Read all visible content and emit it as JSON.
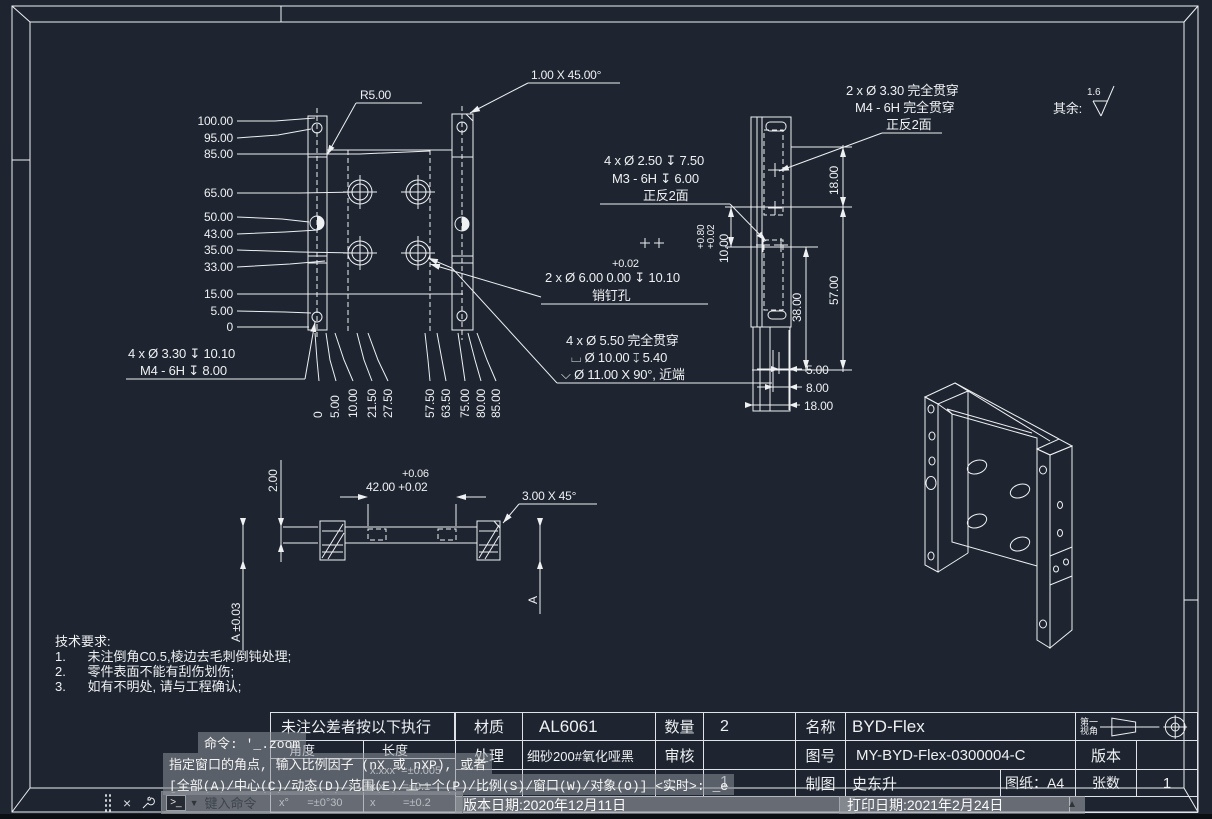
{
  "colors": {
    "background": "#1e2530",
    "line": "#eef0f2",
    "overlay_bg": "#8c9299",
    "status_strip": "#0b0e12"
  },
  "front_view": {
    "left_dims": [
      "100.00",
      "95.00",
      "85.00",
      "65.00",
      "50.00",
      "43.00",
      "35.00",
      "33.00",
      "15.00",
      "5.00",
      "0"
    ],
    "bottom_dims": [
      "0",
      "5.00",
      "10.00",
      "21.50",
      "27.50",
      "57.50",
      "63.50",
      "75.00",
      "80.00",
      "85.00"
    ]
  },
  "side_view": {
    "d18": "18.00",
    "d57": "57.00",
    "d38": "38.00",
    "d10": "10.00",
    "d10_tol_upper": "+0.80",
    "d10_tol_lower": "+0.02",
    "b5": "5.00",
    "b8": "8.00",
    "b18": "18.00"
  },
  "callouts": {
    "radius": "R5.00",
    "chamfer_top": "1.00 X 45.00°",
    "m4_top": [
      "2 x Ø  3.30 完全贯穿",
      "M4 - 6H 完全贯穿",
      "正反2面"
    ],
    "m3": [
      "4 x Ø  2.50 ↧  7.50",
      "M3 - 6H ↧  6.00",
      "正反2面"
    ],
    "dowel_tol": "+0.02",
    "dowel": "2 x Ø  6.00  0.00 ↧  10.10",
    "dowel_note": "销钉孔",
    "cbore": [
      "4 x Ø  5.50 完全贯穿",
      "⌴  Ø  10.00 ↧  5.40",
      "⌵  Ø  11.00 X 90°, 近端"
    ],
    "m4_left": [
      "4 x Ø  3.30 ↧  10.10",
      "M4 - 6H ↧  8.00"
    ],
    "surface_prefix": "其余:",
    "surface_value": "1.6",
    "section_tol_upper": "+0.06",
    "section_width": "42.00 +0.02",
    "section_thickness": "2.00",
    "section_chamfer": "3.00 X 45°",
    "datum_left": "A ±0.03",
    "datum_right": "A"
  },
  "tech_requirements": {
    "title": "技术要求:",
    "item1": "1.      未注倒角C0.5,棱边去毛刺倒钝处理;",
    "item2": "2.      零件表面不能有刮伤划伤;",
    "item3": "3.      如有不明处, 请与工程确认;"
  },
  "title_block": {
    "tolerance_note": "未注公差者按以下执行",
    "angle_header": "角度",
    "length_header": "长度",
    "angle_tol": "x°      =±0°30",
    "length_tol_1": "x.xxx  =±0.005",
    "length_tol_2": "x.x      =±0.1",
    "length_tol_3": "x         =±0.2",
    "material_label": "材质",
    "material": "AL6061",
    "finish_label": "处理",
    "finish": "细砂200#氧化哑黑",
    "qty_label": "数量",
    "qty": "2",
    "check_label": "审核",
    "check": "",
    "scale_value": "1",
    "name_label": "名称",
    "name": "BYD-Flex",
    "drawing_no_label": "图号",
    "drawing_no": "MY-BYD-Flex-0300004-C",
    "version_label": "版本",
    "version": "",
    "drafter_label": "制图",
    "drafter": "史东升",
    "sheet_label": "图纸：A4",
    "sheets_label": "张数",
    "sheets": "1",
    "projection_label_1": "第一",
    "projection_label_2": "视角",
    "version_date": "版本日期:2020年12月11日",
    "print_date": "打印日期:2021年2月24日"
  },
  "command_panel": {
    "history_1": "命令: '_.zoom",
    "history_2": "指定窗口的角点, 输入比例因子 (nX 或 nXP), 或者",
    "history_3": "[全部(A)/中心(C)/动态(D)/范围(E)/上一个(P)/比例(S)/窗口(W)/对象(O)] <实时>: _e",
    "input_placeholder": "键入命令",
    "close_icon": "×",
    "dropdown_icon": "▼",
    "scroll_up_icon": "▲"
  }
}
